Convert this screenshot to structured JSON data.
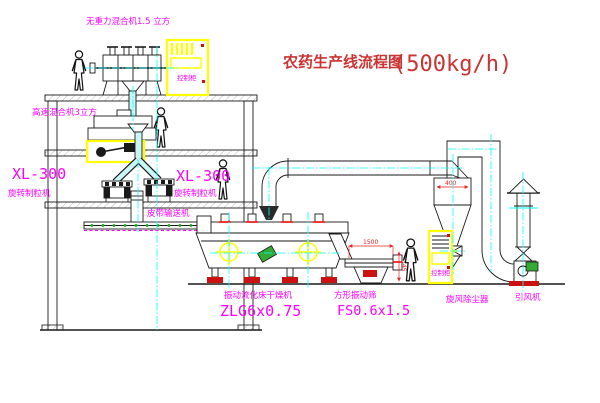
{
  "title": {
    "name_cn": "农药生产线流程图",
    "capacity": "(500kg/h)"
  },
  "colors": {
    "background": "#ffffff",
    "line": "#1a1a1a",
    "centerline_cyan": "#00ffff",
    "label_magenta": "#ff00ff",
    "title_red": "#cc3333",
    "dimension_red": "#ee2222",
    "highlight_yellow": "#ffff00",
    "motor_green": "#33aa33",
    "base_red": "#cc1111"
  },
  "labels": {
    "top_mixer": "无重力混合机1.5 立方",
    "high_speed_mixer": "高速混合机3立方",
    "granulator_left": {
      "model": "XL-300",
      "name": "旋转制粒机"
    },
    "granulator_mid": {
      "model": "XL-300",
      "name": "旋转制粒机"
    },
    "belt_conveyor": "皮带输送机",
    "dryer": {
      "name": "振动流化床干燥机",
      "model": "ZLG6x0.75"
    },
    "sieve": {
      "name": "方形振动筛",
      "model": "FS0.6x1.5"
    },
    "cyclone": "旋风除尘器",
    "fan": "引风机",
    "cabinet_top": "控制柜",
    "cabinet_right": "控制柜"
  },
  "dimensions": {
    "sieve_length": "1500",
    "sieve_height": "345",
    "cyclone_width": "400"
  }
}
